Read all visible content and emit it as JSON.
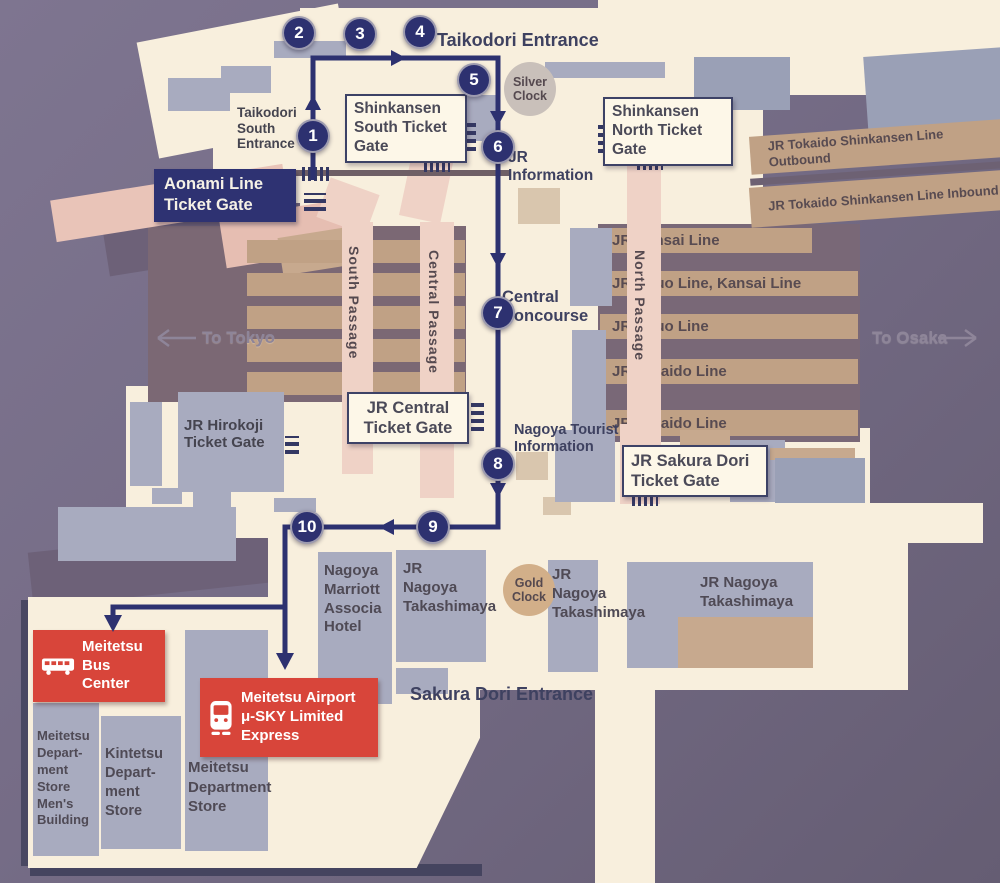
{
  "route": {
    "waypoints": [
      "1",
      "2",
      "3",
      "4",
      "5",
      "6",
      "7",
      "8",
      "9",
      "10"
    ]
  },
  "entrances": {
    "taikodori": "Taikodori Entrance",
    "taikodori_south": "Taikodori South Entrance",
    "sakura_dori": "Sakura Dori Entrance"
  },
  "gates": {
    "aonami": "Aonami Line Ticket Gate",
    "shinkansen_south": "Shinkansen South Ticket Gate",
    "shinkansen_north": "Shinkansen North Ticket Gate",
    "jr_central": "JR Central Ticket Gate",
    "jr_sakura_dori": "JR Sakura Dori Ticket Gate",
    "jr_hirokoji": "JR Hirokoji Ticket Gate"
  },
  "info": {
    "jr_information": "JR Information",
    "tourist_information": "Nagoya Tourist Information",
    "central_concourse": "Central Concourse",
    "silver_clock": "Silver Clock",
    "gold_clock": "Gold Clock"
  },
  "passages": [
    "South Passage",
    "Central Passage",
    "North Passage"
  ],
  "platforms": {
    "jr": [
      "JR Kansai Line",
      "JR Chuo Line, Kansai Line",
      "JR Chuo Line",
      "JR Tokaido Line",
      "JR Tokaido Line"
    ],
    "shinkansen": [
      "JR Tokaido Shinkansen Line Outbound",
      "JR Tokaido Shinkansen Line Inbound"
    ]
  },
  "directions": {
    "to_tokyo": "To Tokyo",
    "to_osaka": "To Osaka"
  },
  "buildings": {
    "marriott": "Nagoya Marriott Associa Hotel",
    "takashimaya": [
      "JR Nagoya Takashimaya",
      "JR Nagoya Takashimaya",
      "JR Nagoya Takashimaya"
    ],
    "meitetsu_mens": "Meitetsu Depart- ment Store Men's Building",
    "kintetsu": "Kintetsu Depart- ment Store",
    "meitetsu_dept": "Meitetsu Department Store"
  },
  "transit": {
    "bus_center": "Meitetsu Bus Center",
    "airport_express": "Meitetsu Airport μ-SKY Limited Express"
  },
  "colors": {
    "navy": "#2d3170",
    "red": "#d8453a",
    "cream": "#f8efdd",
    "building_gray": "#a8abbf",
    "platform_tan": "#c0a185",
    "passage_pink": "#efd2c6",
    "background": "#746b85"
  },
  "icons": {
    "bus": "bus-icon",
    "train": "train-icon",
    "to_tokyo_arrow": "arrow-left-icon",
    "to_osaka_arrow": "arrow-right-icon"
  }
}
